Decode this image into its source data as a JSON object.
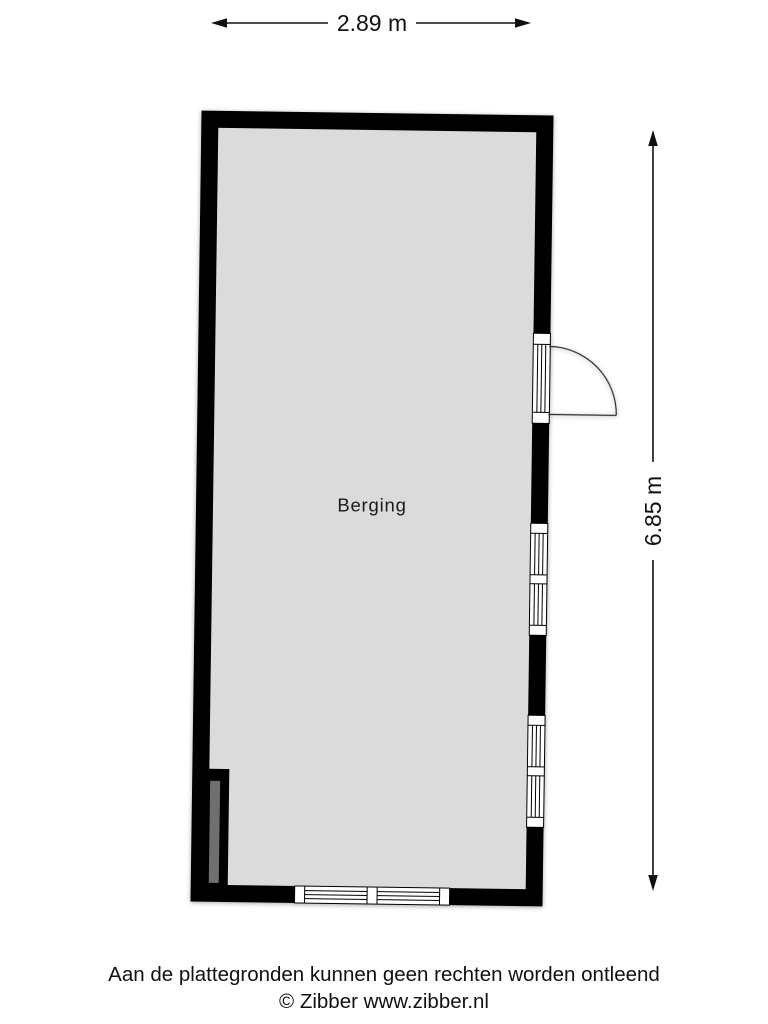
{
  "dimensions": {
    "width_label": "2.89 m",
    "height_label": "6.85 m"
  },
  "room": {
    "label": "Berging"
  },
  "footer": {
    "disclaimer": "Aan de plattegronden kunnen geen rechten worden ontleend",
    "copyright": "© Zibber www.zibber.nl"
  },
  "colors": {
    "background": "#ffffff",
    "wall": "#000000",
    "floor": "#dbdbdb",
    "pillar": "#6f6f6f",
    "window_fill": "#ffffff",
    "dimension_line": "#111111",
    "text": "#1a1a1a"
  }
}
